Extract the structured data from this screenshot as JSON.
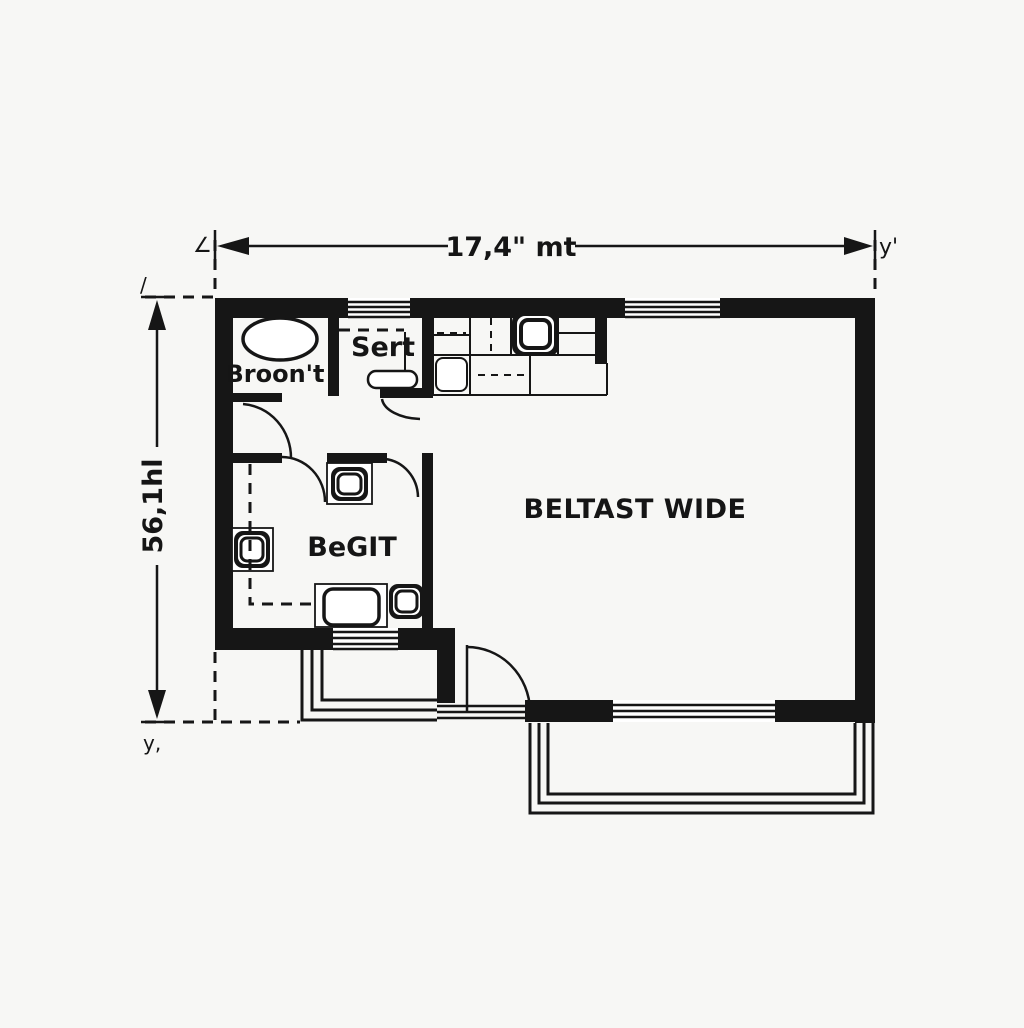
{
  "plan": {
    "type": "architectural-floor-plan",
    "colors": {
      "wall": "#161616",
      "background": "#f7f7f5"
    },
    "dimensions": {
      "top": {
        "label": "17,4\" mt",
        "left_mark": "∠",
        "right_mark": "y'"
      },
      "left": {
        "label": "56,1hl",
        "top_mark": "/",
        "bottom_mark": "y,"
      }
    },
    "rooms": {
      "broont": {
        "label": "Broon't"
      },
      "sert": {
        "label": "Sert"
      },
      "begit": {
        "label": "BeGIT"
      },
      "living": {
        "label": "BELTAST WIDE"
      }
    },
    "fixtures": [
      "bathtub",
      "stove-burner",
      "kitchen-sink",
      "toilet",
      "wall-basin",
      "vanity",
      "corner-basin",
      "sert-toilet"
    ]
  }
}
